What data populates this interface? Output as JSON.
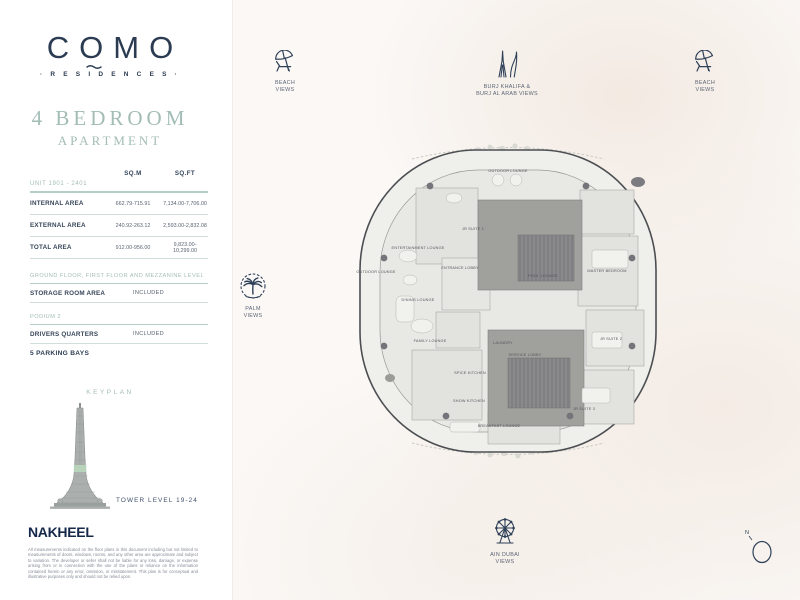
{
  "brand": {
    "logo": "COMO",
    "sub": "· R E S I D E N C E S ·"
  },
  "title": {
    "line1": "4 BEDROOM",
    "line2": "APARTMENT"
  },
  "area_table": {
    "unit_label": "UNIT 1901 - 2401",
    "col_sqm": "SQ.M",
    "col_sqft": "SQ.FT",
    "rows": [
      {
        "label": "INTERNAL AREA",
        "sqm": "662.79-715.91",
        "sqft": "7,134.00-7,706.00"
      },
      {
        "label": "EXTERNAL AREA",
        "sqm": "240.92-263.12",
        "sqft": "2,593.00-2,832.08"
      },
      {
        "label": "TOTAL AREA",
        "sqm": "912.00-956.00",
        "sqft": "9,823.00-10,299.00"
      }
    ]
  },
  "extras": [
    {
      "section": "GROUND FLOOR, FIRST FLOOR AND MEZZANINE LEVEL",
      "label": "STORAGE ROOM AREA",
      "value": "INCLUDED"
    },
    {
      "section": "PODIUM 2",
      "label": "DRIVERS QUARTERS",
      "value": "INCLUDED"
    }
  ],
  "parking": "5 PARKING BAYS",
  "keyplan": {
    "title": "KEYPLAN",
    "level": "TOWER LEVEL 19-24"
  },
  "developer": "NAKHEEL",
  "disclaimer": "All measurements indicated on the floor plans in this document including but not limited to measurements of doors, windows, rooms, and any other area are approximate and subject to variation. The developer or seller shall not be liable for any loss, damage, or expense arising from or in connection with the use of the plans or reliance on the information contained herein or any error, omission, or misstatement. This plan is for conceptual and illustrative purposes only and should not be relied upon.",
  "views": {
    "beach_left": {
      "l1": "BEACH",
      "l2": "VIEWS"
    },
    "burj": {
      "l1": "BURJ KHALIFA &",
      "l2": "BURJ AL ARAB VIEWS"
    },
    "beach_right": {
      "l1": "BEACH",
      "l2": "VIEWS"
    },
    "palm": {
      "l1": "PALM",
      "l2": "VIEWS"
    },
    "ain": {
      "l1": "AIN DUBAI",
      "l2": "VIEWS"
    }
  },
  "compass": {
    "label": "N"
  },
  "floorplan": {
    "rooms": [
      "OUTDOOR LOUNGE",
      "JR SUITE 1",
      "ENTERTAINMENT LOUNGE",
      "OUTDOOR LOUNGE",
      "ENTRANCE LOBBY",
      "POOL LOUNGE",
      "MASTER BEDROOM",
      "DINING LOUNGE",
      "FAMILY LOUNGE",
      "LAUNDRY",
      "SERVICE LOBBY",
      "SPICE KITCHEN",
      "SHOW KITCHEN",
      "BREAKFAST LOUNGE",
      "JR SUITE 2",
      "JR SUITE 3"
    ]
  },
  "colors": {
    "accent_teal": "#a3bdb6",
    "navy": "#2b3b52",
    "tower_band_green": "#b7d3b9"
  }
}
